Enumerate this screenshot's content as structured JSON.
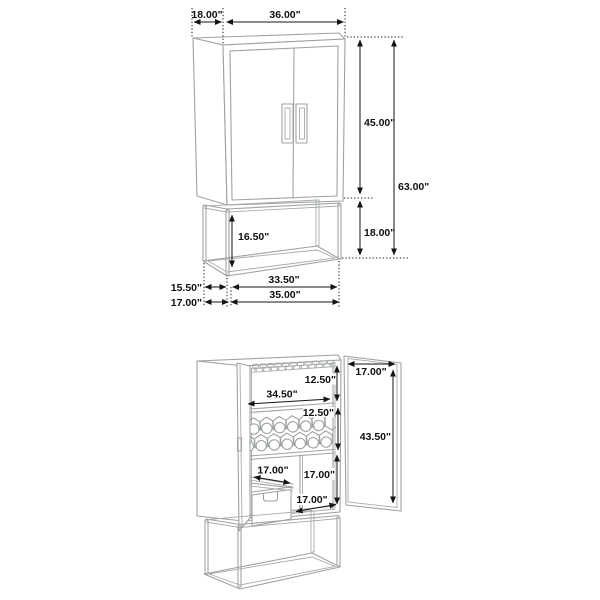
{
  "figure_top": {
    "name": "closed bar cabinet with dimensions",
    "dimensions": {
      "depth_top": "18.00\"",
      "width_top": "36.00\"",
      "door_height": "45.00\"",
      "total_height": "63.00\"",
      "base_height": "18.00\"",
      "base_clearance": "16.50\"",
      "base_depth": "15.50\"",
      "base_width": "33.50\"",
      "floor_depth": "17.00\"",
      "floor_width": "35.00\""
    }
  },
  "figure_bottom": {
    "name": "open bar cabinet with interior dimensions",
    "dimensions": {
      "top_compartment_height": "12.50\"",
      "shelf_width": "34.50\"",
      "wine_rack_height": "12.50\"",
      "open_door_width": "17.00\"",
      "door_panel_height": "43.50\"",
      "drawer_depth": "17.00\"",
      "lower_compartment_height": "17.00\"",
      "bottom_opening_width": "17.00\""
    }
  },
  "colors": {
    "background": "#ffffff",
    "drawing_line": "#9ea2a4",
    "dimension_line": "#141414"
  }
}
